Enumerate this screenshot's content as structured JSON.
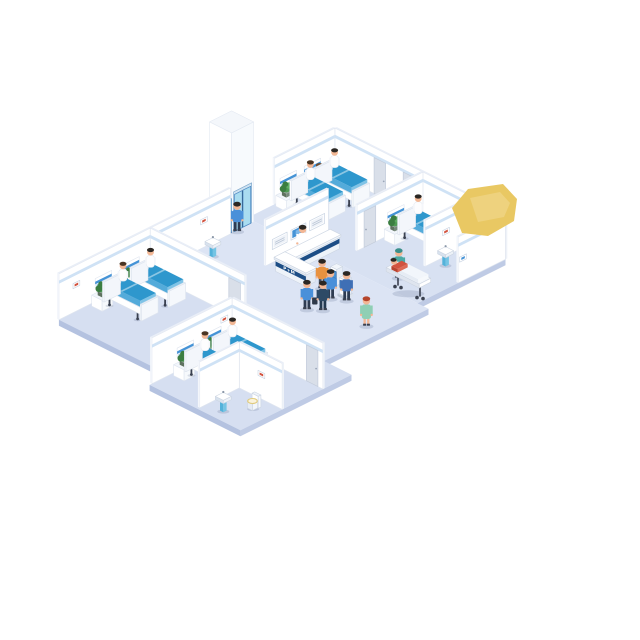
{
  "title": "Isometric hospital ward floor illustration",
  "labels": {
    "reception_desk_sign": "P+M"
  },
  "palette": {
    "floor": "#d8e1f2",
    "floorHub": "#dce4f4",
    "floorRoom": "#d6dff1",
    "floorEdge": "#bfcbe5",
    "floorEdge2": "#b4c2e0",
    "wallFace": "#ffffff",
    "wallStroke": "#dfe5ef",
    "wallTop": "#e9eef7",
    "wallStripe": "#cfe2f5",
    "bedTop": "#2e97cd",
    "bedSide": "#54abda",
    "bedLight": "#7fc3e6",
    "navy": "#1d4e86",
    "screenBlue": "#4593d6",
    "screenPale": "#eef2f8",
    "glass": "#a9dcf0",
    "glassFrame": "#4a86c2",
    "plant": "#4e9b53",
    "plantDark": "#3b7d41",
    "door": "#d9dfe9",
    "doorEdge": "#c3ccdb",
    "metal": "#9aa6b8",
    "dark": "#3a4150",
    "skin": "#f2b795",
    "hairDark": "#2b2723",
    "blanket": "#f2f6fb",
    "redShirt": "#d2533f",
    "yellow": "#e9c863",
    "shadow": "rgba(70,90,130,0.18)"
  },
  "scene": [
    {
      "t": "floor",
      "name": "floor-top-wing",
      "u": 0,
      "v": 0,
      "du": 15.5,
      "dv": 8,
      "se": 1,
      "fill": "#d8e1f2"
    },
    {
      "t": "floor",
      "name": "floor-central-hub",
      "u": 0,
      "v": 8,
      "du": 16.5,
      "dv": 9.5,
      "se": 1,
      "fill": "#dce4f4"
    },
    {
      "t": "floor",
      "name": "floor-room-c-wing",
      "u": 0.7,
      "v": 17.5,
      "du": 10.05,
      "dv": 8.3,
      "sw": 1,
      "fill": "#d6dff1"
    },
    {
      "t": "floor",
      "name": "floor-room-d-wing",
      "u": 10.75,
      "v": 17.5,
      "du": 8.25,
      "dv": 10.1,
      "sw": 1,
      "se": 1,
      "fill": "#d6dff1"
    },
    {
      "t": "elevator",
      "name": "elevator-shaft",
      "u": -1.35,
      "v": 8.05,
      "du": 2,
      "dv": 2,
      "h": 100
    },
    {
      "t": "person",
      "name": "elevator-passenger",
      "u": 0.72,
      "v": 9.62,
      "top": "#4a90d9",
      "bottom": "#2e3c52",
      "hair": "#2b2723"
    },
    {
      "t": "wallV",
      "name": "room-a-west-wall",
      "u": 0,
      "v0": 0,
      "v1": 5.5
    },
    {
      "t": "wallU",
      "name": "north-wall",
      "u0": 0,
      "u1": 15.5,
      "v": 0
    },
    {
      "t": "door",
      "name": "room-a-door",
      "face": "v",
      "u": 3.55,
      "v": 0
    },
    {
      "t": "door",
      "name": "corridor-door",
      "face": "v",
      "u": 6.2,
      "v": 0
    },
    {
      "t": "headwall",
      "name": "headwall-panel-a1",
      "u": 0,
      "v": 1.3
    },
    {
      "t": "headwall",
      "name": "headwall-panel-a2",
      "u": 0,
      "v": 3.5
    },
    {
      "t": "person",
      "name": "nurse-room-a",
      "u": 0.95,
      "v": 2.35,
      "top": "#ffffff",
      "dress": 1,
      "hair": "#6b4a2f"
    },
    {
      "t": "plantcab",
      "name": "bedside-cabinet-a1",
      "u": 0.25,
      "v": 2.42
    },
    {
      "t": "bed",
      "name": "bed-a1",
      "u": 0.45,
      "v": 0.72,
      "patient": 1,
      "hair": "#2b2723"
    },
    {
      "t": "plantcab",
      "name": "bedside-cabinet-a2",
      "u": 0.25,
      "v": 4.68
    },
    {
      "t": "bed",
      "name": "bed-a2",
      "u": 0.45,
      "v": 2.92,
      "patient": 1,
      "hair": "#4a3523"
    },
    {
      "t": "pedsink",
      "name": "corridor-sink",
      "u": 5.7,
      "v": 0.4
    },
    {
      "t": "wallV",
      "name": "room-b-west-wall",
      "u": 8,
      "v0": 0,
      "v1": 6
    },
    {
      "t": "door",
      "name": "room-b-door",
      "face": "u",
      "u": 8,
      "v": 4.3
    },
    {
      "t": "headwall",
      "name": "headwall-panel-b",
      "u": 8,
      "v": 1.72
    },
    {
      "t": "plantcab",
      "name": "bedside-cabinet-b",
      "u": 8.25,
      "v": 2.82
    },
    {
      "t": "person",
      "name": "doctor-room-b",
      "u": 11.95,
      "v": 0.5,
      "top": "#ffffff",
      "bottom": "#3d4a5c",
      "hair": "#2b2723"
    },
    {
      "t": "bed",
      "name": "bed-b1",
      "u": 8.45,
      "v": 1.12,
      "patient": 1,
      "hair": "#2b2723"
    },
    {
      "t": "wallV",
      "name": "bathroom-b-west-wall",
      "u": 12.5,
      "v0": 0,
      "v1": 4.3
    },
    {
      "t": "picture",
      "name": "bathroom-b-picture",
      "face": "u",
      "u": 12.5,
      "v": 2.1,
      "z": 22,
      "color": "red"
    },
    {
      "t": "toilet",
      "name": "bathroom-b-toilet",
      "u": 13.45,
      "v": 0.75
    },
    {
      "t": "pedsink",
      "name": "bathroom-b-sink",
      "u": 13.0,
      "v": 2.95
    },
    {
      "t": "wallV",
      "name": "bathroom-b-east-wall",
      "u": 15.5,
      "v0": 0,
      "v1": 4.3
    },
    {
      "t": "picture",
      "name": "wall-sign-blue",
      "face": "u",
      "u": 15.5,
      "v": 3.55,
      "z": 20,
      "color": "blue"
    },
    {
      "t": "wallV",
      "name": "imaging-wall",
      "u": 5.2,
      "v0": 5.8,
      "v1": 11.5
    },
    {
      "t": "monitor",
      "name": "wall-monitor-1",
      "u": 5.2,
      "v": 6.15,
      "screen": "pale"
    },
    {
      "t": "monitor",
      "name": "wall-monitor-2",
      "u": 5.2,
      "v": 7.85,
      "screen": "blue"
    },
    {
      "t": "monitor",
      "name": "wall-monitor-3",
      "u": 5.2,
      "v": 9.55,
      "screen": "pale"
    },
    {
      "t": "person",
      "name": "receptionist",
      "u": 5.8,
      "v": 8.75,
      "top": "#ffffff",
      "dress": 1,
      "hair": "#2b2723"
    },
    {
      "t": "desk",
      "name": "reception-desk",
      "u": 6.15,
      "v": 6.6
    },
    {
      "t": "kiosk",
      "name": "checkin-kiosk-1",
      "u": 9.9,
      "v": 9.75
    },
    {
      "t": "person",
      "name": "visitor-kiosk-1",
      "u": 9.78,
      "v": 10.95,
      "top": "#e8923f",
      "bottom": "#3d4a5c",
      "hair": "#2b2723"
    },
    {
      "t": "kiosk",
      "name": "checkin-kiosk-2",
      "u": 11.3,
      "v": 10.35
    },
    {
      "t": "person",
      "name": "visitor-kiosk-2",
      "u": 11.1,
      "v": 11.5,
      "top": "#4a90d9",
      "bottom": "#2e3c52",
      "hair": "#2b2723"
    },
    {
      "t": "person",
      "name": "visitor-kiosk-3",
      "u": 12.0,
      "v": 10.95,
      "top": "#3f6fb5",
      "bottom": "#2e3c52",
      "hair": "#2b2723"
    },
    {
      "t": "person",
      "name": "orderly-gurney",
      "u": 12.3,
      "v": 6.5,
      "top": "#4aa9a4",
      "bottom": "#3b8a86",
      "cap": 1
    },
    {
      "t": "gurney",
      "name": "gurney-with-patient",
      "u": 12.55,
      "v": 6.85
    },
    {
      "t": "blob",
      "name": "yellow-highlight-shape",
      "pts": [
        [
          462,
          233
        ],
        [
          452,
          208
        ],
        [
          468,
          189
        ],
        [
          503,
          184
        ],
        [
          517,
          199
        ],
        [
          514,
          221
        ],
        [
          488,
          236
        ]
      ],
      "pts2": [
        [
          470,
          198
        ],
        [
          500,
          192
        ],
        [
          510,
          203
        ],
        [
          504,
          217
        ],
        [
          478,
          222
        ]
      ]
    },
    {
      "t": "wallV",
      "name": "corridor-west-wall",
      "u": 0.7,
      "v0": 10.2,
      "v1": 17.5
    },
    {
      "t": "picture",
      "name": "corridor-picture",
      "face": "u",
      "u": 0.7,
      "v": 12.3,
      "z": 24,
      "color": "red"
    },
    {
      "t": "pedsink",
      "name": "corridor-west-sink",
      "u": 1.6,
      "v": 12.7
    },
    {
      "t": "person",
      "name": "visitor-walking-1",
      "u": 11.0,
      "v": 13.55,
      "top": "#4a90d9",
      "bottom": "#2e3c52",
      "hair": "#2b2723",
      "case": 1
    },
    {
      "t": "person",
      "name": "visitor-walking-2",
      "u": 11.8,
      "v": 12.9,
      "top": "#2e4a66",
      "bottom": "#243a52",
      "hair": "#2b2723"
    },
    {
      "t": "person",
      "name": "nurse-corridor",
      "u": 15.2,
      "v": 12.35,
      "top": "#8fcfb4",
      "dress": 1,
      "hair": "#b5452c"
    },
    {
      "t": "wallU",
      "name": "room-c-north-wall",
      "u0": 0.7,
      "u1": 9.3,
      "v": 17.5
    },
    {
      "t": "door",
      "name": "room-c-door",
      "face": "v",
      "u": 7.85,
      "v": 17.5
    },
    {
      "t": "wallV",
      "name": "room-c-west-wall",
      "u": 0.7,
      "v0": 17.5,
      "v1": 25.8
    },
    {
      "t": "picture",
      "name": "room-c-picture",
      "face": "u",
      "u": 0.7,
      "v": 23.9,
      "z": 24,
      "color": "red"
    },
    {
      "t": "headwall",
      "name": "headwall-panel-c1",
      "u": 0.7,
      "v": 18.5
    },
    {
      "t": "headwall",
      "name": "headwall-panel-c2",
      "u": 0.7,
      "v": 21.0
    },
    {
      "t": "plantcab",
      "name": "bedside-cabinet-c1",
      "u": 0.95,
      "v": 19.62
    },
    {
      "t": "person",
      "name": "nurse-room-c",
      "u": 2.1,
      "v": 20.35,
      "top": "#ffffff",
      "dress": 1,
      "hair": "#6b4a2f"
    },
    {
      "t": "bed",
      "name": "bed-c1",
      "u": 1.15,
      "v": 18.15,
      "patient": 1,
      "hair": "#2b2723"
    },
    {
      "t": "plantcab",
      "name": "bedside-cabinet-c2",
      "u": 0.95,
      "v": 22.12
    },
    {
      "t": "bed",
      "name": "bed-c2",
      "u": 1.15,
      "v": 20.65,
      "patient": 1,
      "hair": "#4a3523"
    },
    {
      "t": "pedsink",
      "name": "room-c-sink",
      "u": 8.1,
      "v": 23.6
    },
    {
      "t": "wallU",
      "name": "room-d-north-wall",
      "u0": 10.75,
      "u1": 19,
      "v": 20.1
    },
    {
      "t": "door",
      "name": "room-d-door",
      "face": "v",
      "u": 17.5,
      "v": 20.1
    },
    {
      "t": "wallV",
      "name": "room-d-west-wall",
      "u": 10.75,
      "v0": 20.1,
      "v1": 27.4
    },
    {
      "t": "picture",
      "name": "room-d-picture",
      "face": "u",
      "u": 10.75,
      "v": 20.5,
      "z": 26,
      "color": "red"
    },
    {
      "t": "headwall",
      "name": "headwall-panel-d1",
      "u": 10.75,
      "v": 21.1
    },
    {
      "t": "headwall",
      "name": "headwall-panel-d2",
      "u": 10.75,
      "v": 23.6
    },
    {
      "t": "plantcab",
      "name": "bedside-cabinet-d1",
      "u": 11.0,
      "v": 22.22
    },
    {
      "t": "person",
      "name": "nurse-room-d",
      "u": 12.35,
      "v": 22.8,
      "top": "#ffffff",
      "dress": 1,
      "hair": "#2b2723"
    },
    {
      "t": "bed",
      "name": "bed-d1",
      "u": 11.2,
      "v": 20.75,
      "patient": 1,
      "hair": "#2b2723"
    },
    {
      "t": "plantcab",
      "name": "bedside-cabinet-d2",
      "u": 11.0,
      "v": 24.72
    },
    {
      "t": "bed",
      "name": "bed-d2",
      "u": 11.2,
      "v": 23.25,
      "patient": 1,
      "hair": "#4a3523"
    },
    {
      "t": "wallU",
      "name": "bathroom-d-north-wall",
      "u0": 15.1,
      "u1": 19,
      "v": 23.8
    },
    {
      "t": "wallV",
      "name": "bathroom-d-west-wall",
      "u": 15.1,
      "v0": 23.8,
      "v1": 27.4
    },
    {
      "t": "picture",
      "name": "bathroom-d-picture",
      "face": "v",
      "u": 16.8,
      "v": 23.8,
      "z": 22,
      "color": "red"
    },
    {
      "t": "toilet",
      "name": "bathroom-d-toilet",
      "u": 17.25,
      "v": 24.55
    },
    {
      "t": "pedsink",
      "name": "bathroom-d-sink",
      "u": 16.15,
      "v": 26.3
    }
  ]
}
